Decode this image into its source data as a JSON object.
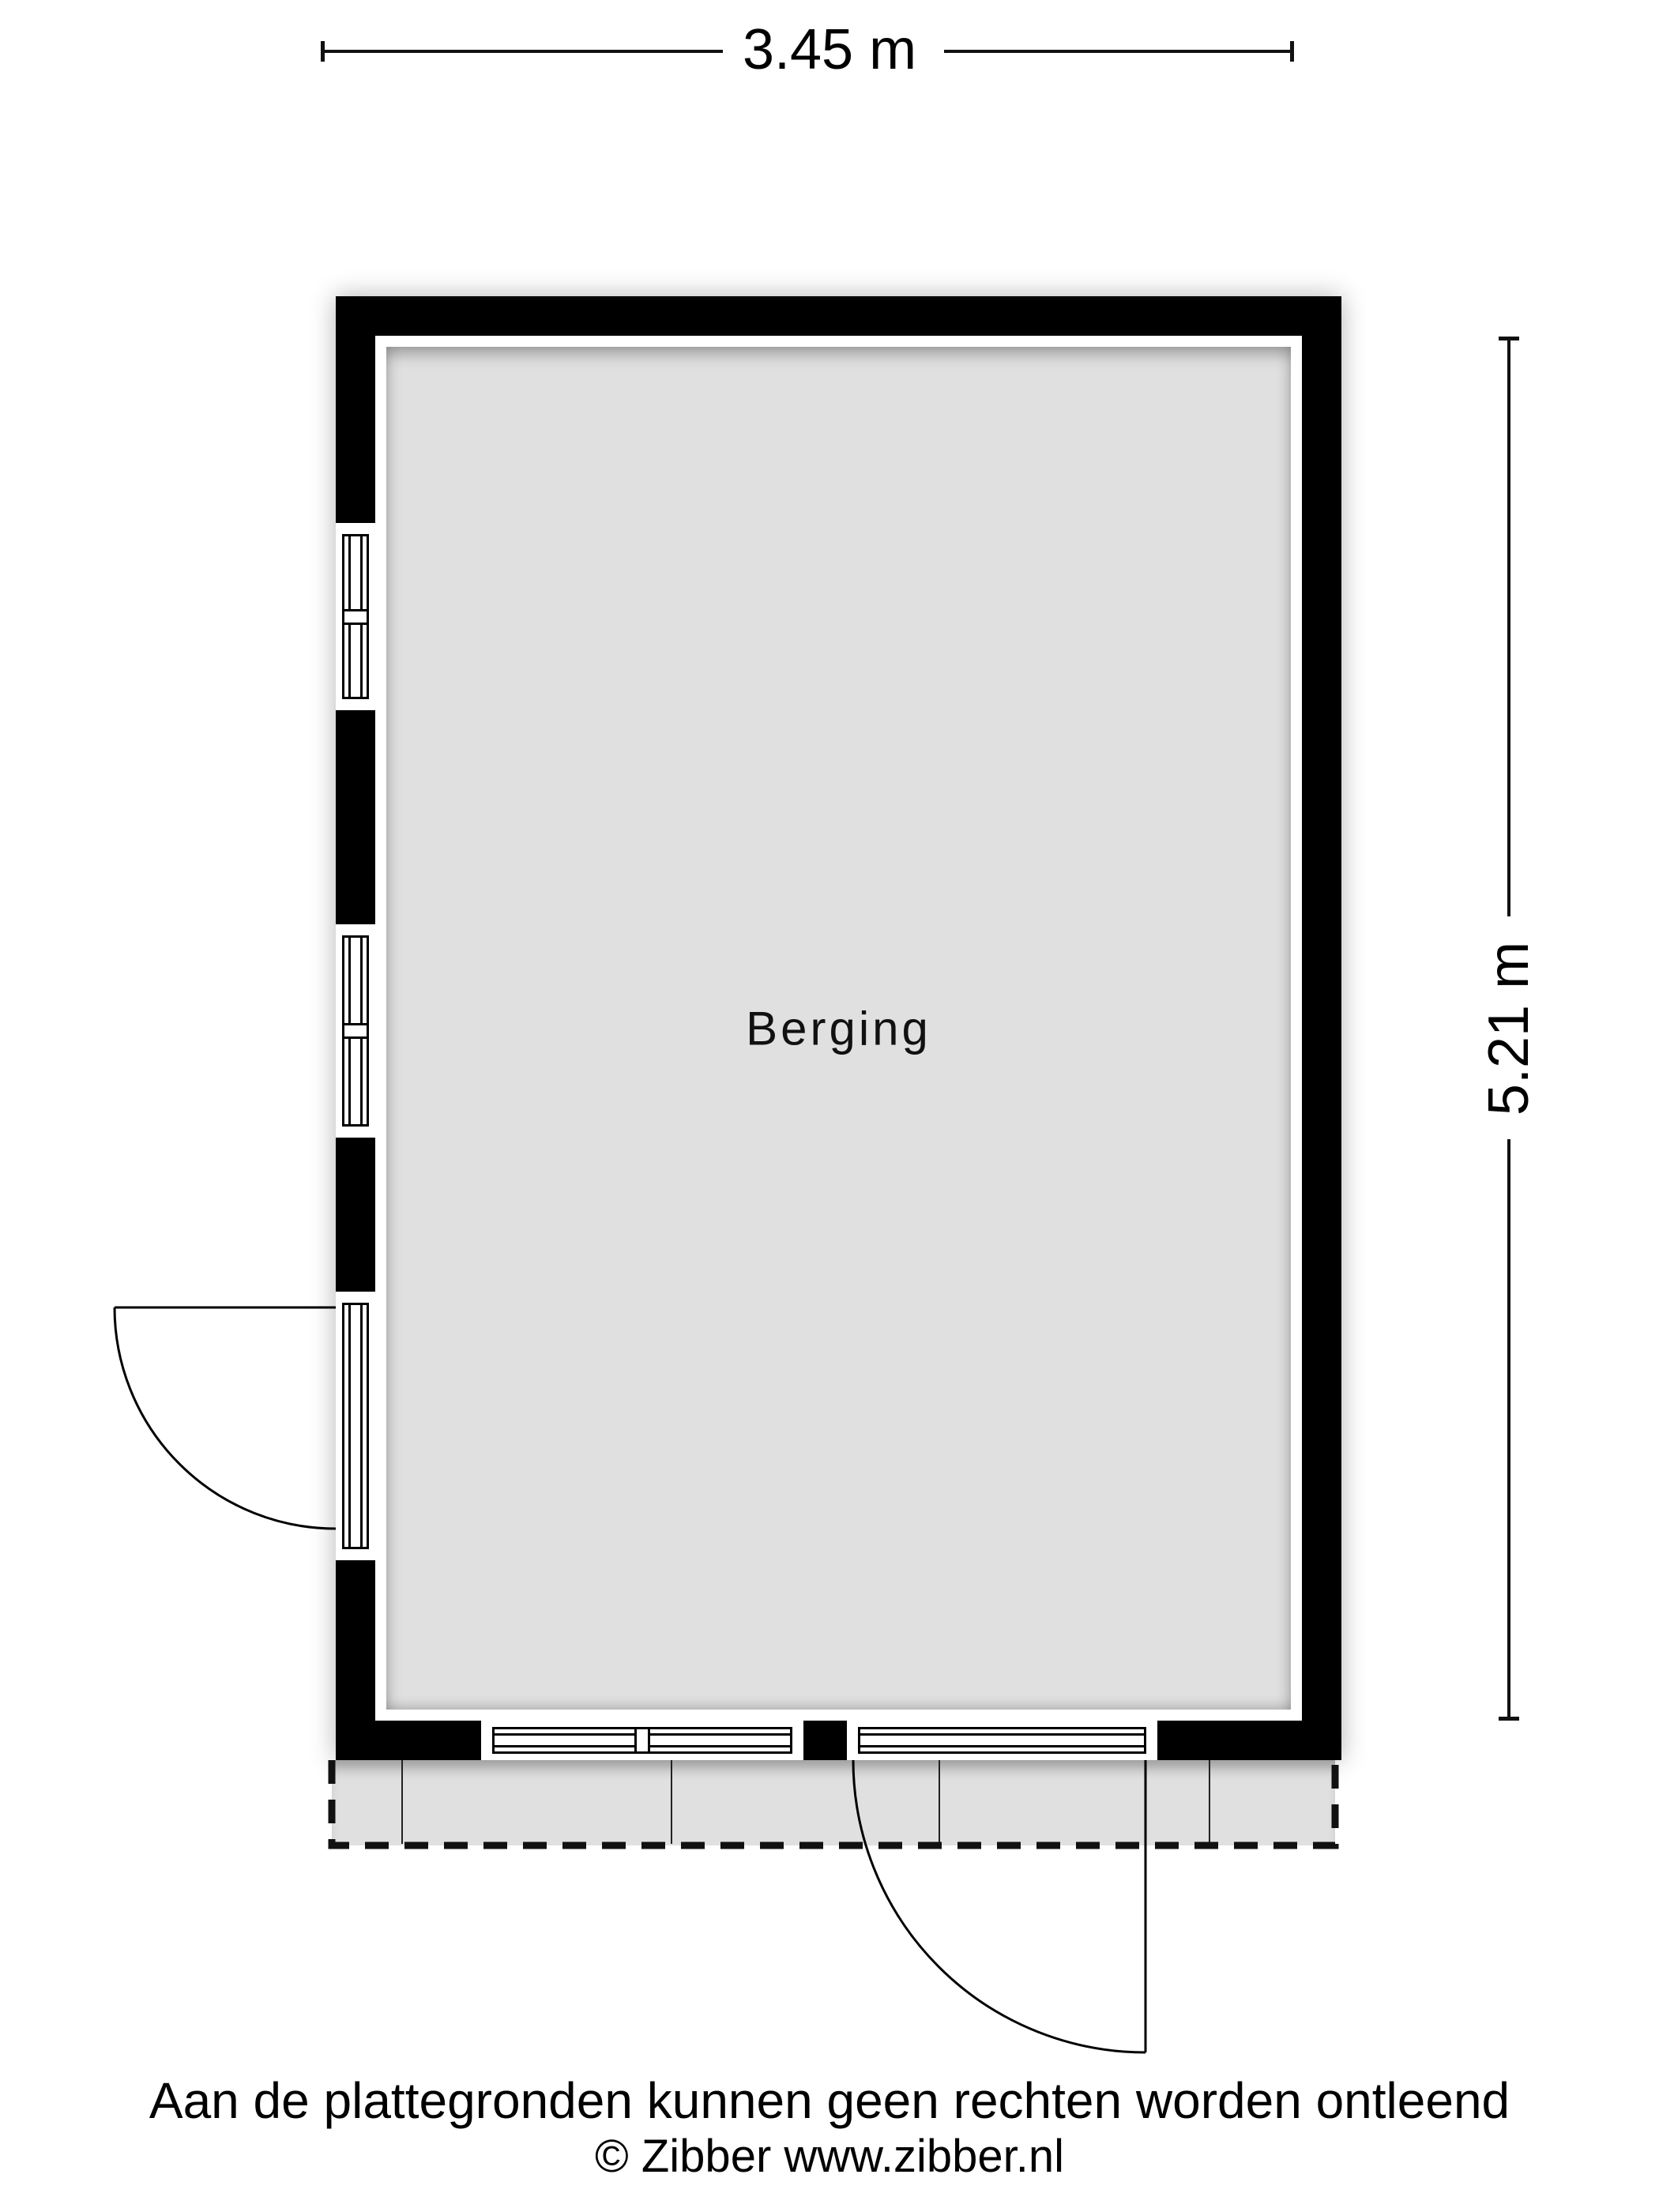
{
  "plan": {
    "room_label": "Berging",
    "dimensions": {
      "width_label": "3.45 m",
      "height_label": "5.21 m"
    }
  },
  "footer": {
    "disclaimer": "Aan de plattegronden kunnen geen rechten worden ontleend",
    "credit": "© Zibber www.zibber.nl"
  },
  "colors": {
    "wall": "#000000",
    "floor": "#e0e0e0",
    "apron": "#e0e0e0",
    "line": "#111111"
  }
}
